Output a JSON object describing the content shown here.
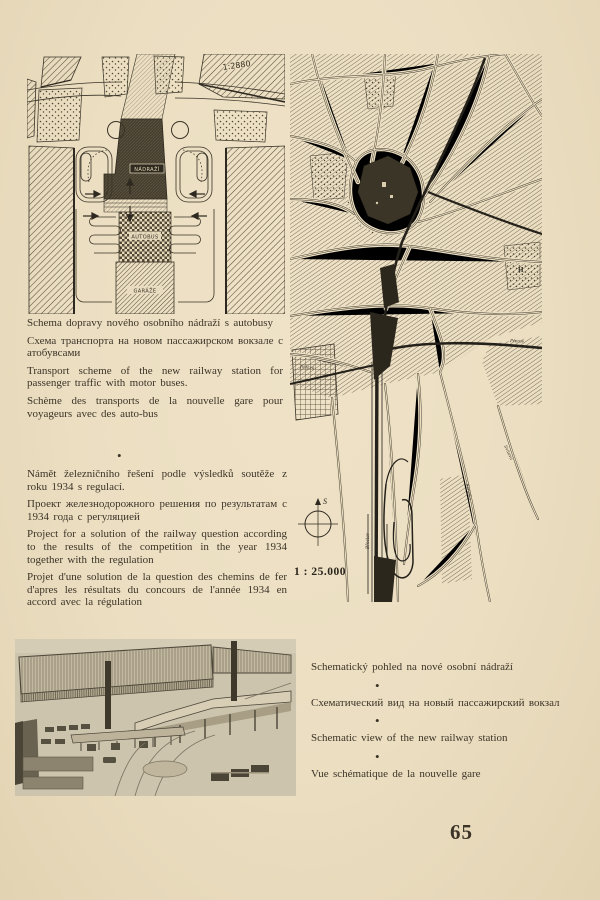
{
  "page": {
    "number": "65",
    "paper_color": "#ebdec1",
    "ink_color": "#3c3428"
  },
  "bullet": "•",
  "plan_small": {
    "scale_label": "1:2880",
    "station_label": "NÁDRAŽÍ",
    "bus_label": "AUTOBUS",
    "garage_label": "GARÁŽE"
  },
  "map_large": {
    "scale_label": "1 : 25.000",
    "compass_north_letter": "S",
    "area_label_h": "H",
    "road_labels": {
      "west": "Jihlava",
      "south": "Břeclav",
      "river1": "Svratka",
      "river2": "Svitava",
      "east": "Přerov"
    }
  },
  "captions_transport": {
    "cs": "Schema dopravy nového osobního nádraží s autobusy",
    "ru": "Схема транспорта на новом пассажирском вокзале с атобувсами",
    "en": "Transport scheme of the new railway station for passenger traffic with motor buses.",
    "fr": "Schème des transports de la nouvelle gare pour voyageurs avec des auto-bus"
  },
  "captions_project": {
    "cs": "Námět železničního řešení podle výsledků soutěže z roku 1934 s regulací.",
    "ru": "Проект железнодорожного решения по результатам с 1934 года с регуляцией",
    "en": "Project for a solution of the railway question according to the results of the competition in the year 1934 together with the regulation",
    "fr": "Projet d'une solution de la question des chemins de fer d'apres les résultats du concours de l'année 1934 en accord avec la régulation"
  },
  "captions_view": {
    "cs": "Schematický pohled na nové osobní nádraží",
    "ru": "Схематический вид на новый пассажирский вокзал",
    "en": "Schematic view of the new railway station",
    "fr": "Vue schématique de la nouvelle gare"
  }
}
